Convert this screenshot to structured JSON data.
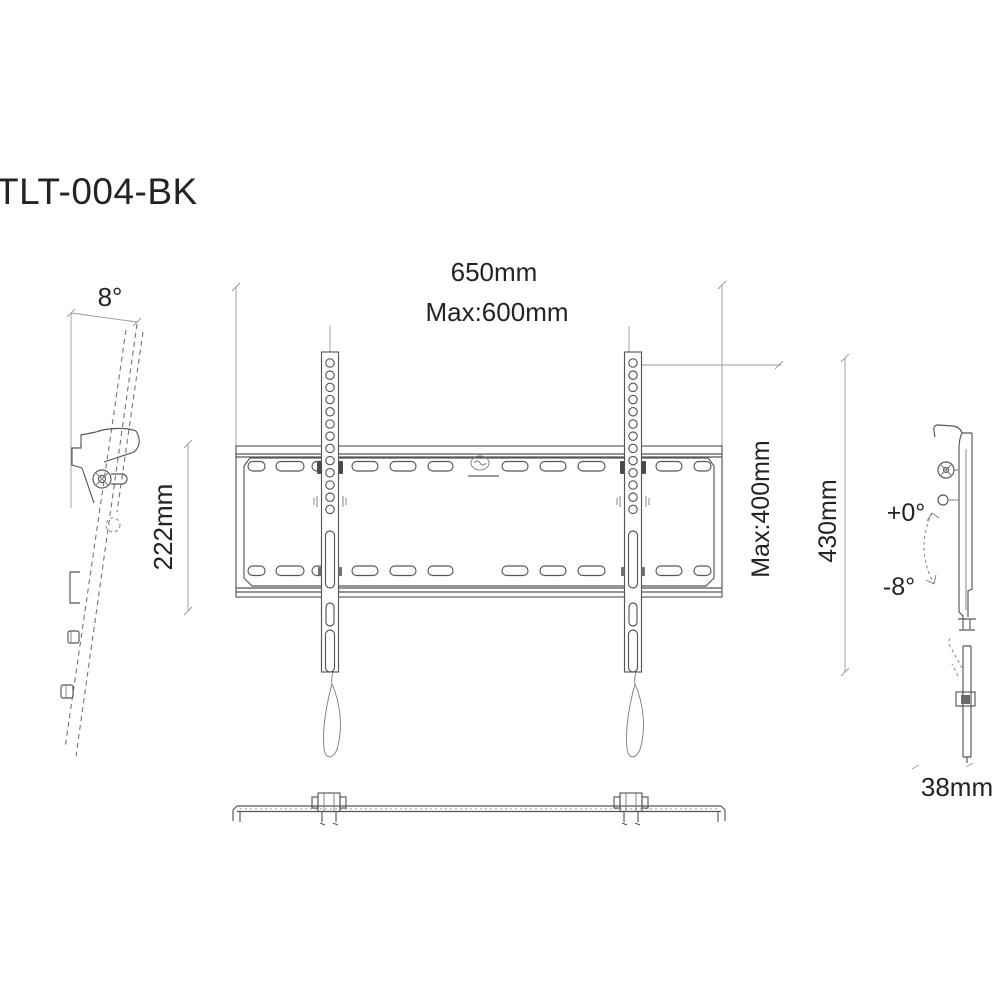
{
  "title": "TLT-004-BK",
  "views": {
    "side_left": {
      "tilt_angle": "8°",
      "drop_height": "222mm"
    },
    "front": {
      "overall_width": "650mm",
      "max_hole_pattern_width": "Max:600mm",
      "max_hole_pattern_height": "Max:400mm",
      "overall_height": "430mm"
    },
    "side_right": {
      "tilt_max": "+0°",
      "tilt_min": "-8°",
      "profile_depth": "38mm"
    }
  },
  "colors": {
    "background": "#ffffff",
    "drawing_line": "#565656",
    "dimension_line": "#999999",
    "text": "#232323"
  }
}
